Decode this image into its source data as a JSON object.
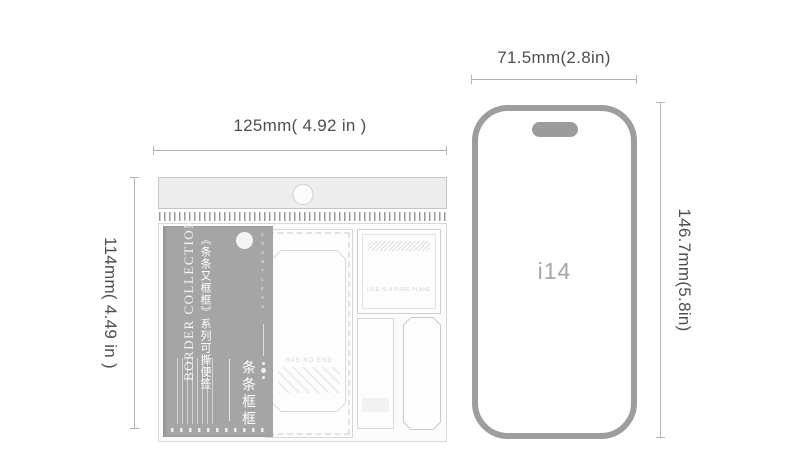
{
  "package": {
    "width_label": "125mm( 4.92 in )",
    "height_label": "114mm( 4.49 in )",
    "label_card": {
      "series_title_en": "BORDER COLLECTION",
      "series_title_cn": "《条条又框框》系列可撕便签",
      "product_name_cn": "条条框框",
      "side_letters": "COUNTLESS"
    },
    "contents": {
      "large_pad_text": "HAS NO END",
      "top_right_pad_text": "LIFE IS A PURE PLANE"
    }
  },
  "phone": {
    "model_label": "i14",
    "width_label": "71.5mm(2.8in)",
    "height_label": "146.7mm(5.8in)"
  },
  "colors": {
    "dimension_line": "#b3b3b3",
    "dimension_text": "#4f4f4f",
    "phone_outline": "#9d9d9d",
    "label_card_bg": "#a5a5a5"
  }
}
